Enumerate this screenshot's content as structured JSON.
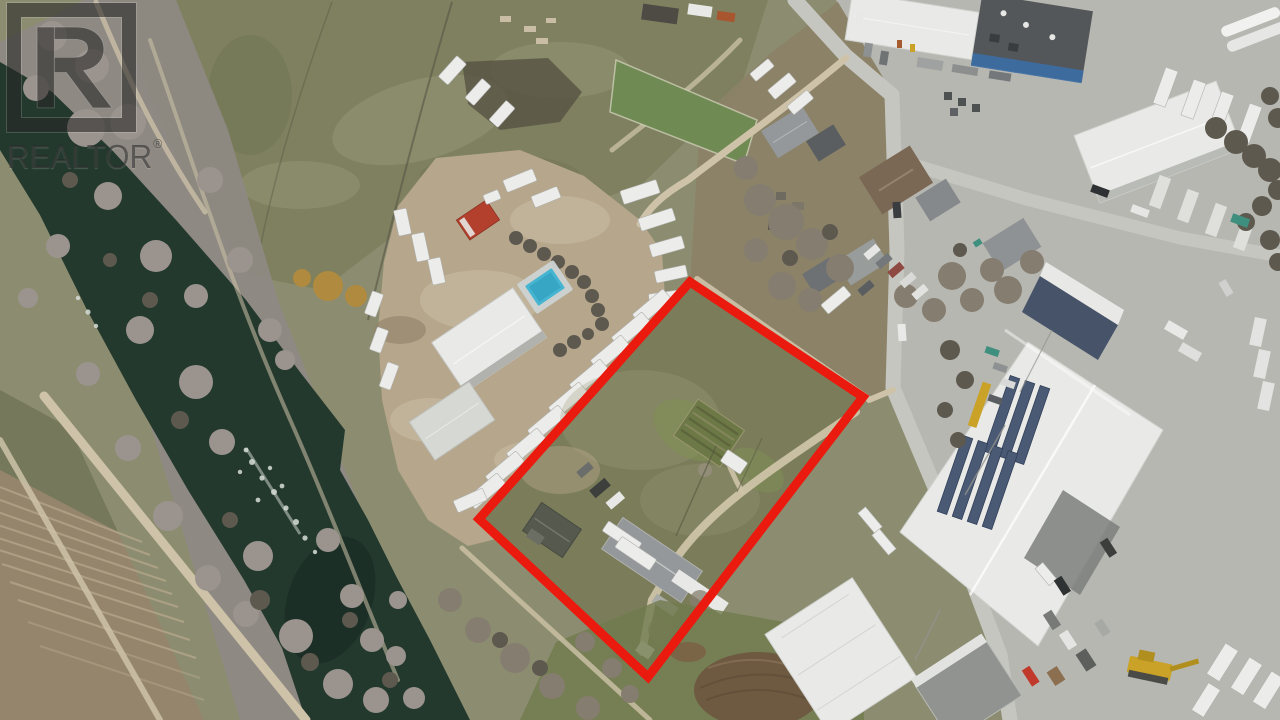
{
  "watermark": {
    "brand": "REALTOR",
    "registered": "®",
    "logo_letter": "R"
  },
  "boundary": {
    "label": "subject-property-outline",
    "color": "#ea1a0e",
    "shape": "rotated-rectangle",
    "corners_px": [
      [
        690,
        282
      ],
      [
        863,
        397
      ],
      [
        648,
        677
      ],
      [
        479,
        519
      ]
    ]
  },
  "palette": {
    "base": "#8c8d70",
    "asphalt": "#b7b7b2",
    "road": "#c6c6c0",
    "hill": "#7e805f",
    "hillLight": "#9b9c7a",
    "pasture": "#6f8a52",
    "yards": "#8b8267",
    "dirt": "#b5a68c",
    "dirtLight": "#c9bca1",
    "field": "#95856c",
    "fieldGreen": "#76785c",
    "furrow": "#b7a88d",
    "treeBase": "#8e8983",
    "river": "#24392e",
    "riverDark": "#1b2f27",
    "rapids": "#d7ded8",
    "treeGray": "#9b948e",
    "treeDark": "#5e594f",
    "treeSouth": "#857d6f",
    "grassProp": "#7b7d5a",
    "grassSouth": "#707a4d",
    "trail": "#cec3a8",
    "rv": "#ecedeb",
    "rvStroke": "#b0b1ad",
    "roofWhite": "#e9eae7",
    "roofGray": "#95989a",
    "roofDark": "#54575a",
    "roofBrown": "#7a6854",
    "solar": "#4a5a74",
    "solarStroke": "#32405a",
    "pool": "#45b5d1",
    "poolDeck": "#cdd3d3",
    "redShed": "#b2402d",
    "soil": "#6e5a41",
    "machineYellow": "#c9a227",
    "carRed": "#c0392b",
    "navy": "#33425a",
    "golden": "#b08a3e",
    "watermark": "rgba(38,38,38,0.58)"
  },
  "scene": {
    "type": "aerial-drone-photograph",
    "elements": [
      "river-with-rapids",
      "bare-riverbank-trees",
      "plowed-field",
      "grass-hill",
      "rv-storage-yard",
      "storage-office-building",
      "swimming-pool",
      "red-roof-shed",
      "subject-property-lot",
      "farm-house",
      "barn-shed",
      "garden-plot",
      "dirt-driveway",
      "red-property-boundary",
      "residential-houses",
      "streets",
      "industrial-warehouse",
      "solar-panel-roof",
      "semi-trailers",
      "soil-heap",
      "yellow-excavator",
      "realtor-watermark"
    ]
  }
}
